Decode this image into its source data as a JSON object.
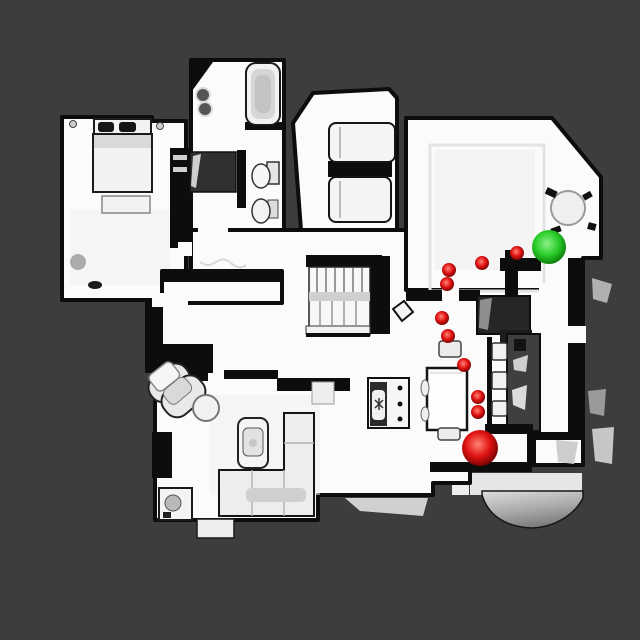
{
  "scene": {
    "colors": {
      "background": "#3d3d3d",
      "floor": "#fbfbfb",
      "floor_shade": "#f0f0f0",
      "wall": "#0d0d0d",
      "furniture_fill": "#f2f2f2",
      "furniture_stroke": "#1b1b1b",
      "counter_dark": "#2a2a2a",
      "exterior_gray": "#b3b3b3",
      "rug_line": "#e4e4e4"
    }
  },
  "markers": {
    "red_gradient": {
      "highlight": "#ff8475",
      "mid": "#e01212",
      "edge": "#740202"
    },
    "green_gradient": {
      "highlight": "#8df08a",
      "mid": "#2bce2b",
      "edge": "#0a7c0a"
    },
    "small_red_spheres": [
      {
        "x": 517,
        "y": 253,
        "r": 7
      },
      {
        "x": 482,
        "y": 263,
        "r": 7
      },
      {
        "x": 449,
        "y": 270,
        "r": 7
      },
      {
        "x": 447,
        "y": 284,
        "r": 7
      },
      {
        "x": 442,
        "y": 318,
        "r": 7
      },
      {
        "x": 448,
        "y": 336,
        "r": 7
      },
      {
        "x": 464,
        "y": 365,
        "r": 7
      },
      {
        "x": 478,
        "y": 397,
        "r": 7
      },
      {
        "x": 478,
        "y": 412,
        "r": 7
      }
    ],
    "large_red_sphere": {
      "x": 480,
      "y": 448,
      "r": 18
    },
    "green_sphere": {
      "x": 549,
      "y": 247,
      "r": 17
    }
  }
}
